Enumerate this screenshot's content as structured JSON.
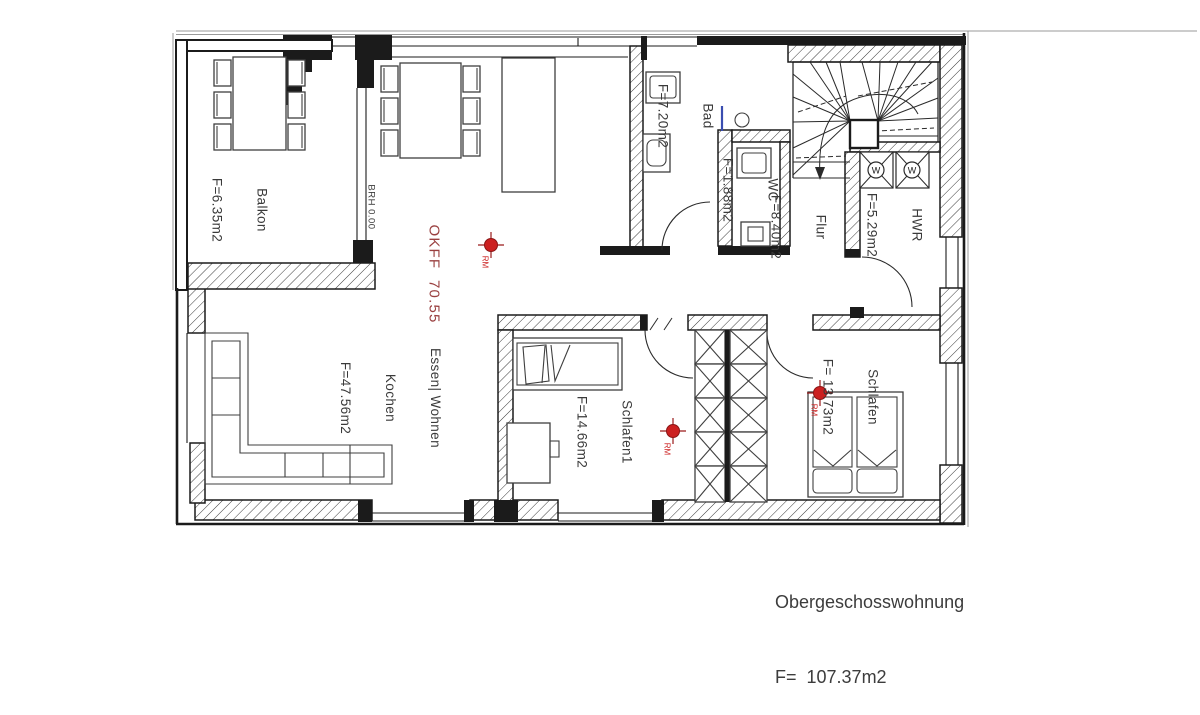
{
  "title": "Obergeschosswohnung Grundriss",
  "rooms": [
    {
      "key": "balkon",
      "lines": [
        "Balkon",
        "F=6.35m2"
      ],
      "area_m2": "6.35"
    },
    {
      "key": "bad",
      "lines": [
        "Bad",
        "F=7.20m2"
      ],
      "area_m2": "7.20"
    },
    {
      "key": "wc",
      "lines": [
        "WC",
        "F=1.88m2"
      ],
      "area_m2": "1.88"
    },
    {
      "key": "flur",
      "lines": [
        "Flur",
        "F=8.40m2"
      ],
      "area_m2": "8.40"
    },
    {
      "key": "hwr",
      "lines": [
        "HWR",
        "F=5.29m2"
      ],
      "area_m2": "5.29"
    },
    {
      "key": "wohnen",
      "lines": [
        "Essen| Wohnen",
        "Kochen",
        "F=47.56m2"
      ],
      "area_m2": "47.56"
    },
    {
      "key": "schlafen1",
      "lines": [
        "Schlafen1",
        "F=14.66m2"
      ],
      "area_m2": "14.66"
    },
    {
      "key": "schlafen",
      "lines": [
        "Schlafen",
        "F= 13.73m2"
      ],
      "area_m2": "13.73"
    }
  ],
  "annotations": {
    "okff": "OKFF  70.55",
    "brh": "BRH 0.00",
    "rm": "RM",
    "washer": "W"
  },
  "footer": {
    "title": "Obergeschosswohnung",
    "area": "F=  107.37m2"
  },
  "colors": {
    "wall": "#1b1b1b",
    "furniture": "#3f3f3f",
    "detector_red": "#cc2020",
    "okff_red": "#9a4040",
    "shower_blue": "#3a4db0",
    "label_gray": "#3a3a3a"
  }
}
